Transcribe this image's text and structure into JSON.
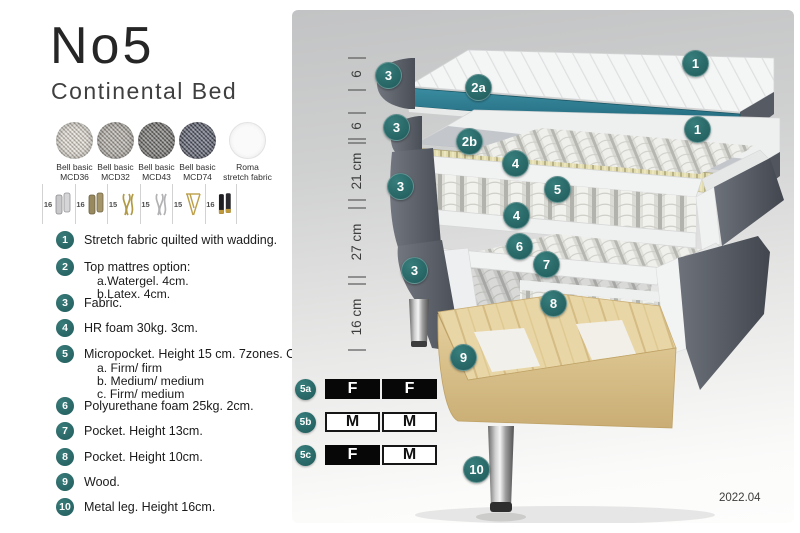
{
  "header": {
    "title": "No5",
    "subtitle": "Continental Bed"
  },
  "swatches": [
    {
      "line1": "Bell basic",
      "line2": "MCD36",
      "color": "#d7d3c9"
    },
    {
      "line1": "Bell basic",
      "line2": "MCD32",
      "color": "#a29e97"
    },
    {
      "line1": "Bell basic",
      "line2": "MCD43",
      "color": "#5d5d5b"
    },
    {
      "line1": "Bell basic",
      "line2": "MCD74",
      "color": "#3e4357"
    },
    {
      "line1": "Roma",
      "line2": "stretch fabric",
      "color": "#fafafa"
    }
  ],
  "legs": [
    {
      "size": "16",
      "icon": "leg-cylinder-silver-icon"
    },
    {
      "size": "16",
      "icon": "leg-cylinder-bronze-icon"
    },
    {
      "size": "15",
      "icon": "leg-twist-gold-icon"
    },
    {
      "size": "15",
      "icon": "leg-twist-silver-icon"
    },
    {
      "size": "15",
      "icon": "leg-hairpin-gold-icon"
    },
    {
      "size": "16",
      "icon": "leg-cylinder-black-gold-icon"
    }
  ],
  "list": [
    {
      "num": "1",
      "text": "Stretch fabric quilted with wadding.",
      "subs": []
    },
    {
      "num": "2",
      "text": "Top mattres option:",
      "subs": [
        "a.Watergel. 4cm.",
        "b.Latex. 4cm."
      ]
    },
    {
      "num": "3",
      "text": "Fabric.",
      "subs": []
    },
    {
      "num": "4",
      "text": "HR foam 30kg. 3cm.",
      "subs": []
    },
    {
      "num": "5",
      "text": "Micropocket. Height 15 cm. 7zones. Option:",
      "subs": [
        "a. Firm/ firm",
        "b. Medium/ medium",
        "c. Firm/ medium"
      ]
    },
    {
      "num": "6",
      "text": "Polyurethane foam 25kg. 2cm.",
      "subs": []
    },
    {
      "num": "7",
      "text": "Pocket. Height 13cm.",
      "subs": []
    },
    {
      "num": "8",
      "text": "Pocket. Height 10cm.",
      "subs": []
    },
    {
      "num": "9",
      "text": "Wood.",
      "subs": []
    },
    {
      "num": "10",
      "text": "Metal leg. Height 16cm.",
      "subs": []
    }
  ],
  "diagram": {
    "ruler": [
      "6",
      "6",
      "21 cm",
      "27 cm",
      "16 cm"
    ],
    "callouts": [
      {
        "label": "1"
      },
      {
        "label": "1"
      },
      {
        "label": "2a"
      },
      {
        "label": "2b"
      },
      {
        "label": "3"
      },
      {
        "label": "3"
      },
      {
        "label": "3"
      },
      {
        "label": "3"
      },
      {
        "label": "4"
      },
      {
        "label": "4"
      },
      {
        "label": "5"
      },
      {
        "label": "6"
      },
      {
        "label": "7"
      },
      {
        "label": "8"
      },
      {
        "label": "9"
      },
      {
        "label": "10"
      }
    ]
  },
  "firmness": {
    "rows": [
      {
        "label": "5a",
        "cells": [
          {
            "text": "F",
            "dark": true
          },
          {
            "text": "F",
            "dark": true
          }
        ]
      },
      {
        "label": "5b",
        "cells": [
          {
            "text": "M",
            "dark": false
          },
          {
            "text": "M",
            "dark": false
          }
        ]
      },
      {
        "label": "5c",
        "cells": [
          {
            "text": "F",
            "dark": true
          },
          {
            "text": "M",
            "dark": false
          }
        ]
      }
    ]
  },
  "footer": {
    "version": "2022.04"
  },
  "colors": {
    "accent_teal": "#2b6f6f",
    "watergel_teal": "#2f7e90",
    "latex_beige": "#e2dbae",
    "fabric_dark_gray": "#565a62",
    "wood": "#e8d6a6"
  }
}
